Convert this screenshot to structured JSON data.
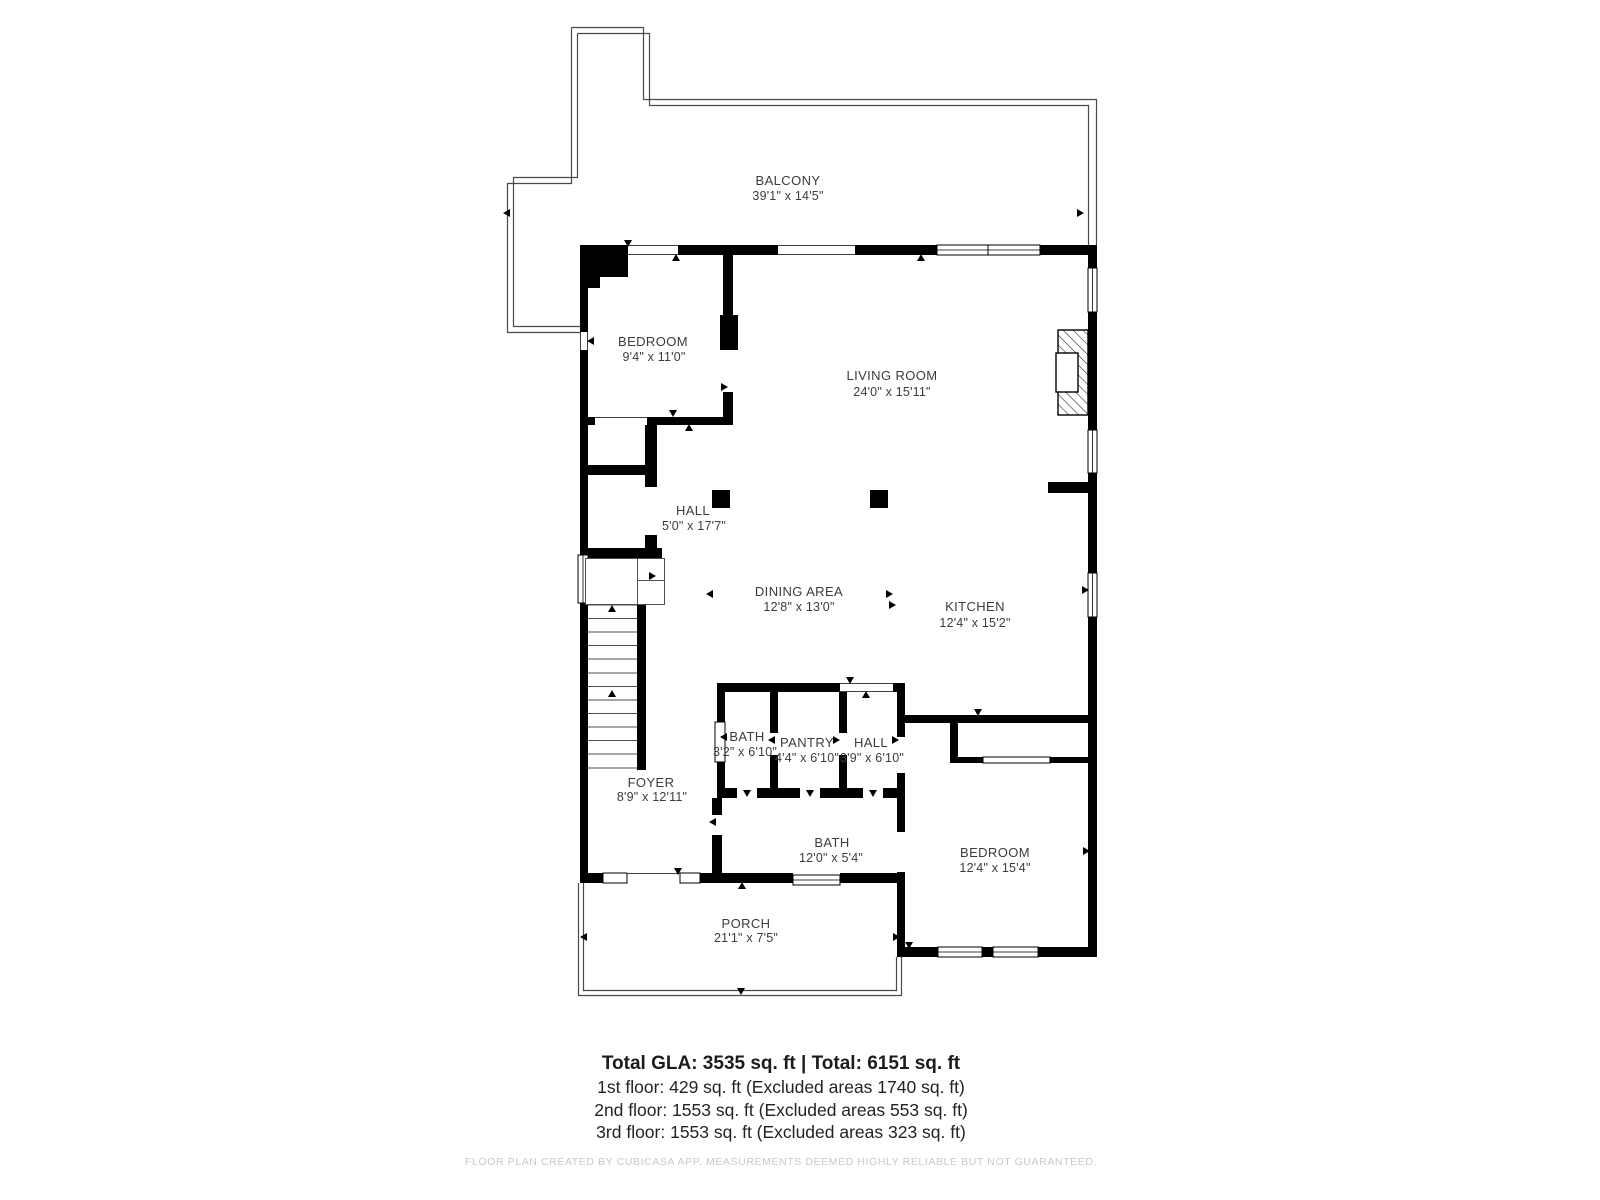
{
  "plan": {
    "rooms": [
      {
        "id": "balcony",
        "label": "BALCONY",
        "dims": "39'1\" x 14'5\""
      },
      {
        "id": "bedroom_upper",
        "label": "BEDROOM",
        "dims": "9'4\" x 11'0\""
      },
      {
        "id": "living_room",
        "label": "LIVING ROOM",
        "dims": "24'0\" x 15'11\""
      },
      {
        "id": "hall_upper",
        "label": "HALL",
        "dims": "5'0\" x 17'7\""
      },
      {
        "id": "dining_area",
        "label": "DINING AREA",
        "dims": "12'8\" x 13'0\""
      },
      {
        "id": "kitchen",
        "label": "KITCHEN",
        "dims": "12'4\" x 15'2\""
      },
      {
        "id": "bath_small",
        "label": "BATH",
        "dims": "3'2\" x 6'10\""
      },
      {
        "id": "pantry",
        "label": "PANTRY",
        "dims": "4'4\" x 6'10\""
      },
      {
        "id": "hall_small",
        "label": "HALL",
        "dims": "3'9\" x 6'10\""
      },
      {
        "id": "foyer",
        "label": "FOYER",
        "dims": "8'9\" x 12'11\""
      },
      {
        "id": "bath_large",
        "label": "BATH",
        "dims": "12'0\" x 5'4\""
      },
      {
        "id": "bedroom_lower",
        "label": "BEDROOM",
        "dims": "12'4\" x 15'4\""
      },
      {
        "id": "porch",
        "label": "PORCH",
        "dims": "21'1\" x 7'5\""
      }
    ]
  },
  "summary": {
    "total": "Total GLA: 3535 sq. ft | Total: 6151 sq. ft",
    "floor1": "1st floor: 429 sq. ft (Excluded areas 1740 sq. ft)",
    "floor2": "2nd floor: 1553 sq. ft (Excluded areas 553 sq. ft)",
    "floor3": "3rd floor: 1553 sq. ft (Excluded areas 323 sq. ft)"
  },
  "footer": "FLOOR PLAN CREATED BY CUBICASA APP. MEASUREMENTS DEEMED HIGHLY RELIABLE BUT NOT GUARANTEED.",
  "colors": {
    "wall": "#000000",
    "text": "#3c3c3c",
    "outline": "#4a4a4a",
    "footer_text": "#c9c9c9"
  }
}
